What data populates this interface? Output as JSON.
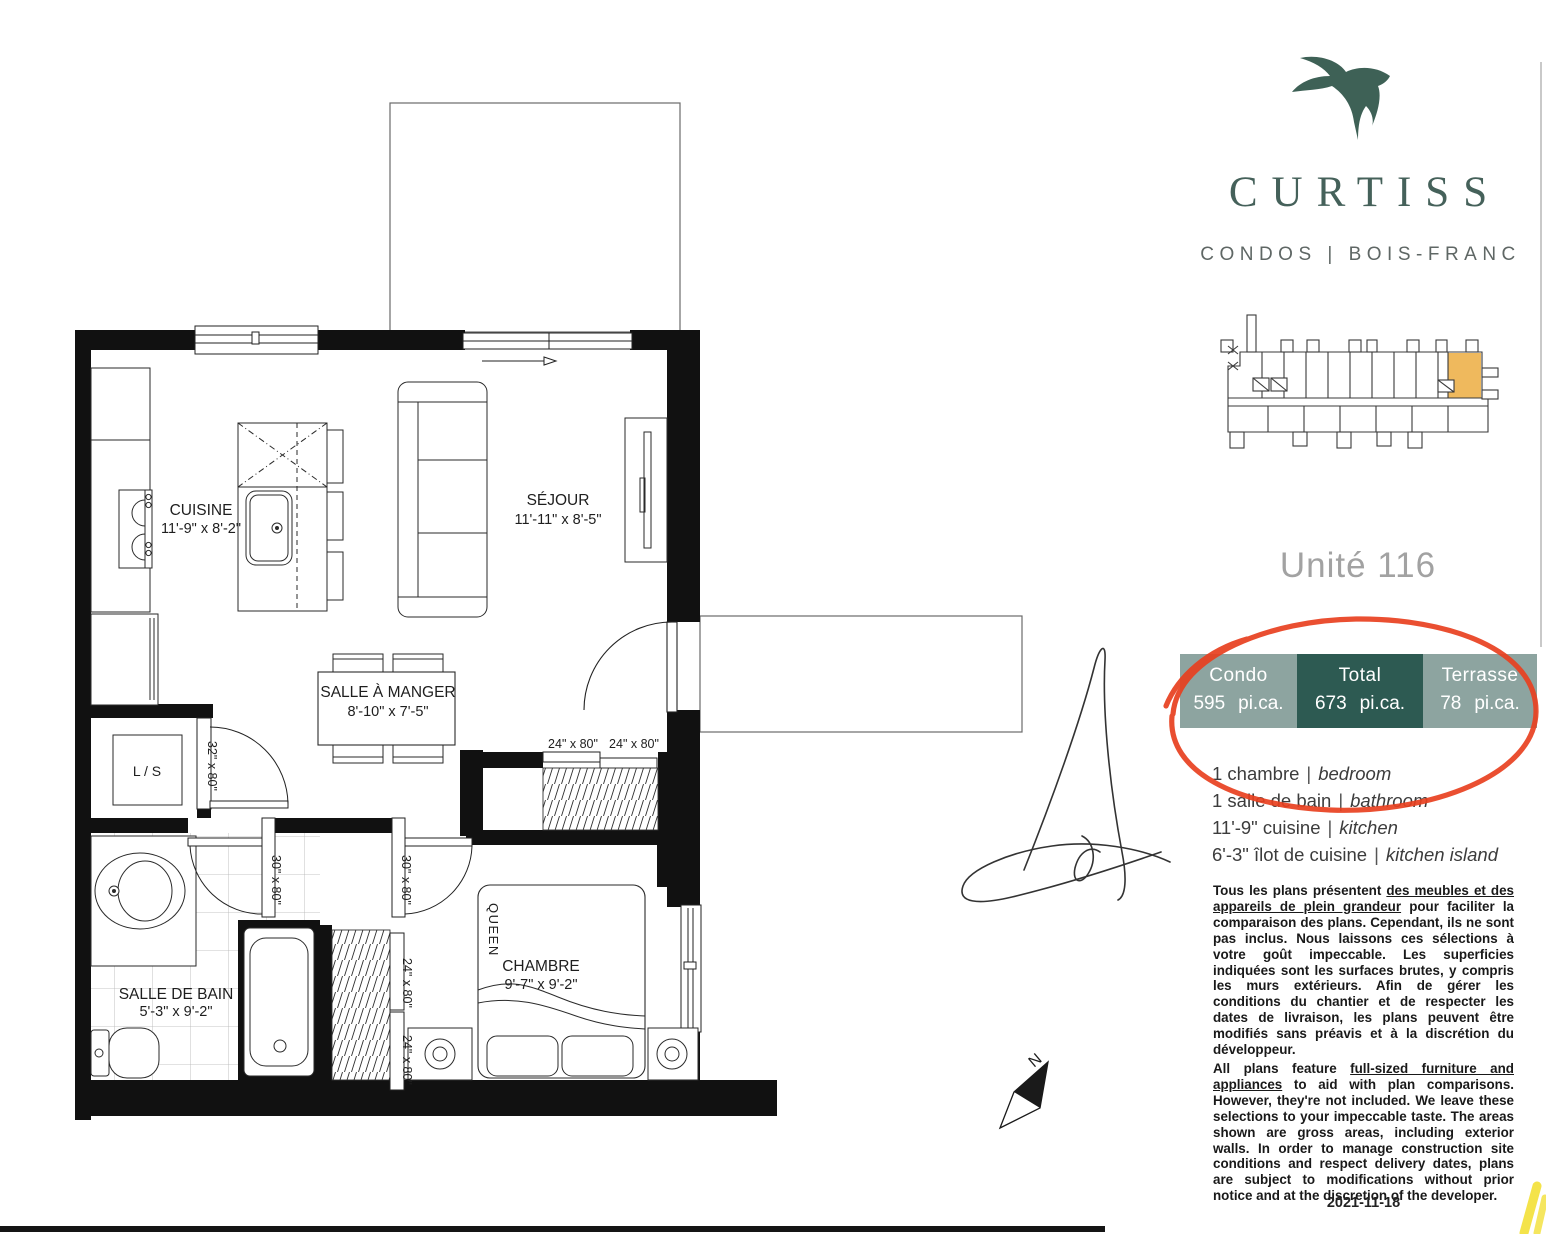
{
  "brand": {
    "name": "CURTISS",
    "tagline": "CONDOS | BOIS-FRANC"
  },
  "unit_title": "Unité 116",
  "area_boxes": {
    "condo": {
      "label": "Condo",
      "value": "595",
      "unit": "pi.ca."
    },
    "total": {
      "label": "Total",
      "value": "673",
      "unit": "pi.ca."
    },
    "terrasse": {
      "label": "Terrasse",
      "value": "78",
      "unit": "pi.ca."
    }
  },
  "features": [
    {
      "fr": "1 chambre",
      "en": "bedroom"
    },
    {
      "fr": "1 salle de bain",
      "en": "bathroom"
    },
    {
      "fr": "11'-9\" cuisine",
      "en": "kitchen"
    },
    {
      "fr": "6'-3\" îlot de cuisine",
      "en": "kitchen island"
    }
  ],
  "ui": {
    "separator": "|"
  },
  "disclaimer_fr": {
    "segments": [
      {
        "t": "Tous les plans présentent "
      },
      {
        "t": "des meubles et des appareils de plein grandeur",
        "u": true
      },
      {
        "t": " pour faciliter la comparaison des plans. Cependant, ils ne sont pas inclus. Nous laissons ces sélections à votre goût impeccable. Les superficies indiquées sont les surfaces brutes, y compris les murs extérieurs. Afin de gérer les conditions du chantier et de respecter les dates de livraison, les plans peuvent être modifiés sans préavis et à la discrétion du développeur."
      }
    ]
  },
  "disclaimer_en": {
    "segments": [
      {
        "t": "All plans feature "
      },
      {
        "t": "full-sized furniture and appliances",
        "u": true
      },
      {
        "t": " to aid with plan comparisons. However, they're not included. We leave these selections to your impeccable taste. The areas shown are gross areas, including exterior walls. In order to manage construction site conditions and respect delivery dates, plans are subject to modifications without prior notice and at the discretion of the developer."
      }
    ]
  },
  "date": "2021-11-18",
  "plan": {
    "rooms": {
      "cuisine": {
        "name": "CUISINE",
        "dims": "11'-9\" x 8'-2\""
      },
      "sejour": {
        "name": "SÉJOUR",
        "dims": "11'-11\" x 8'-5\""
      },
      "salle_a_manger": {
        "name": "SALLE À MANGER",
        "dims": "8'-10\" x 7'-5\""
      },
      "salle_de_bain": {
        "name": "SALLE DE BAIN",
        "dims": "5'-3\" x 9'-2\""
      },
      "chambre": {
        "name": "CHAMBRE",
        "dims": "9'-7\" x 9'-2\""
      }
    },
    "labels": {
      "ls": "L / S",
      "queen": "QUEEN",
      "north": "N"
    },
    "door_sizes": {
      "w24": "24\" x 80\"",
      "w30": "30\" x 80\"",
      "w32": "32\" x 80\""
    }
  },
  "colors": {
    "accent_red": "#e8401f",
    "box_light": "#8da4a0",
    "box_dark": "#2d5a52",
    "logo_green": "#3e6156",
    "logo_text": "#45615a",
    "key_highlight": "#efb95d",
    "highlight_yellow": "#f2de2a"
  }
}
